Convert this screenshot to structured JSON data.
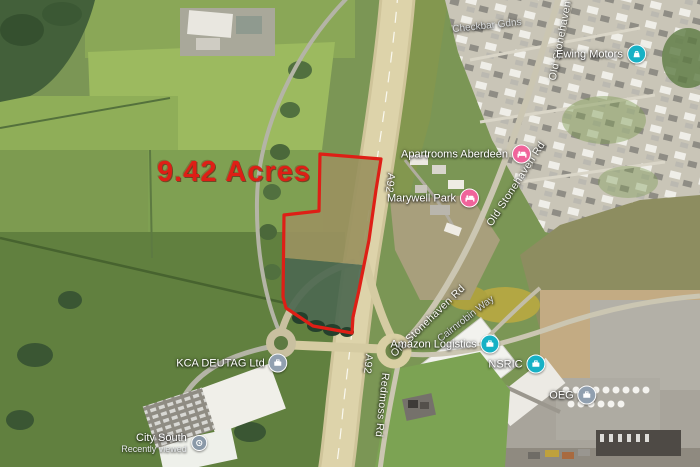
{
  "map_type": "satellite",
  "overlay": {
    "acreage": "9.42 Acres",
    "outline_color": "#de1f16",
    "acreage_text_color": "#de1f16"
  },
  "roads": {
    "a92": "A92",
    "old_stonehaven_rd": "Old Stonehaven Rd",
    "redmoss_rd": "Redmoss Rd",
    "cairnrobin_way": "Cairnrobin Way",
    "checkbar_gdns": "Checkbar Gdns"
  },
  "pois": {
    "ewing_motors": {
      "name": "Ewing Motors",
      "icon": "car-dealer-icon",
      "color": "#17b1c5"
    },
    "apartrooms_aberdeen": {
      "name": "Apartrooms Aberdeen",
      "icon": "lodging-icon",
      "color": "#f0649b"
    },
    "marywell_park": {
      "name": "Marywell Park",
      "icon": "lodging-icon",
      "color": "#f0649b"
    },
    "amazon_logistics": {
      "name": "Amazon Logistics",
      "icon": "business-icon",
      "color": "#17b1c5"
    },
    "nsric": {
      "name": "NSRIC",
      "icon": "business-icon",
      "color": "#17b1c5"
    },
    "oeg": {
      "name": "OEG",
      "icon": "business-icon",
      "color": "#91a0b0"
    },
    "kca_deutag": {
      "name": "KCA DEUTAG Ltd",
      "icon": "business-icon",
      "color": "#91a0b0"
    },
    "city_south": {
      "name": "City South",
      "subtitle": "Recently viewed",
      "icon": "recent-icon",
      "color": "#8a99a8"
    }
  }
}
